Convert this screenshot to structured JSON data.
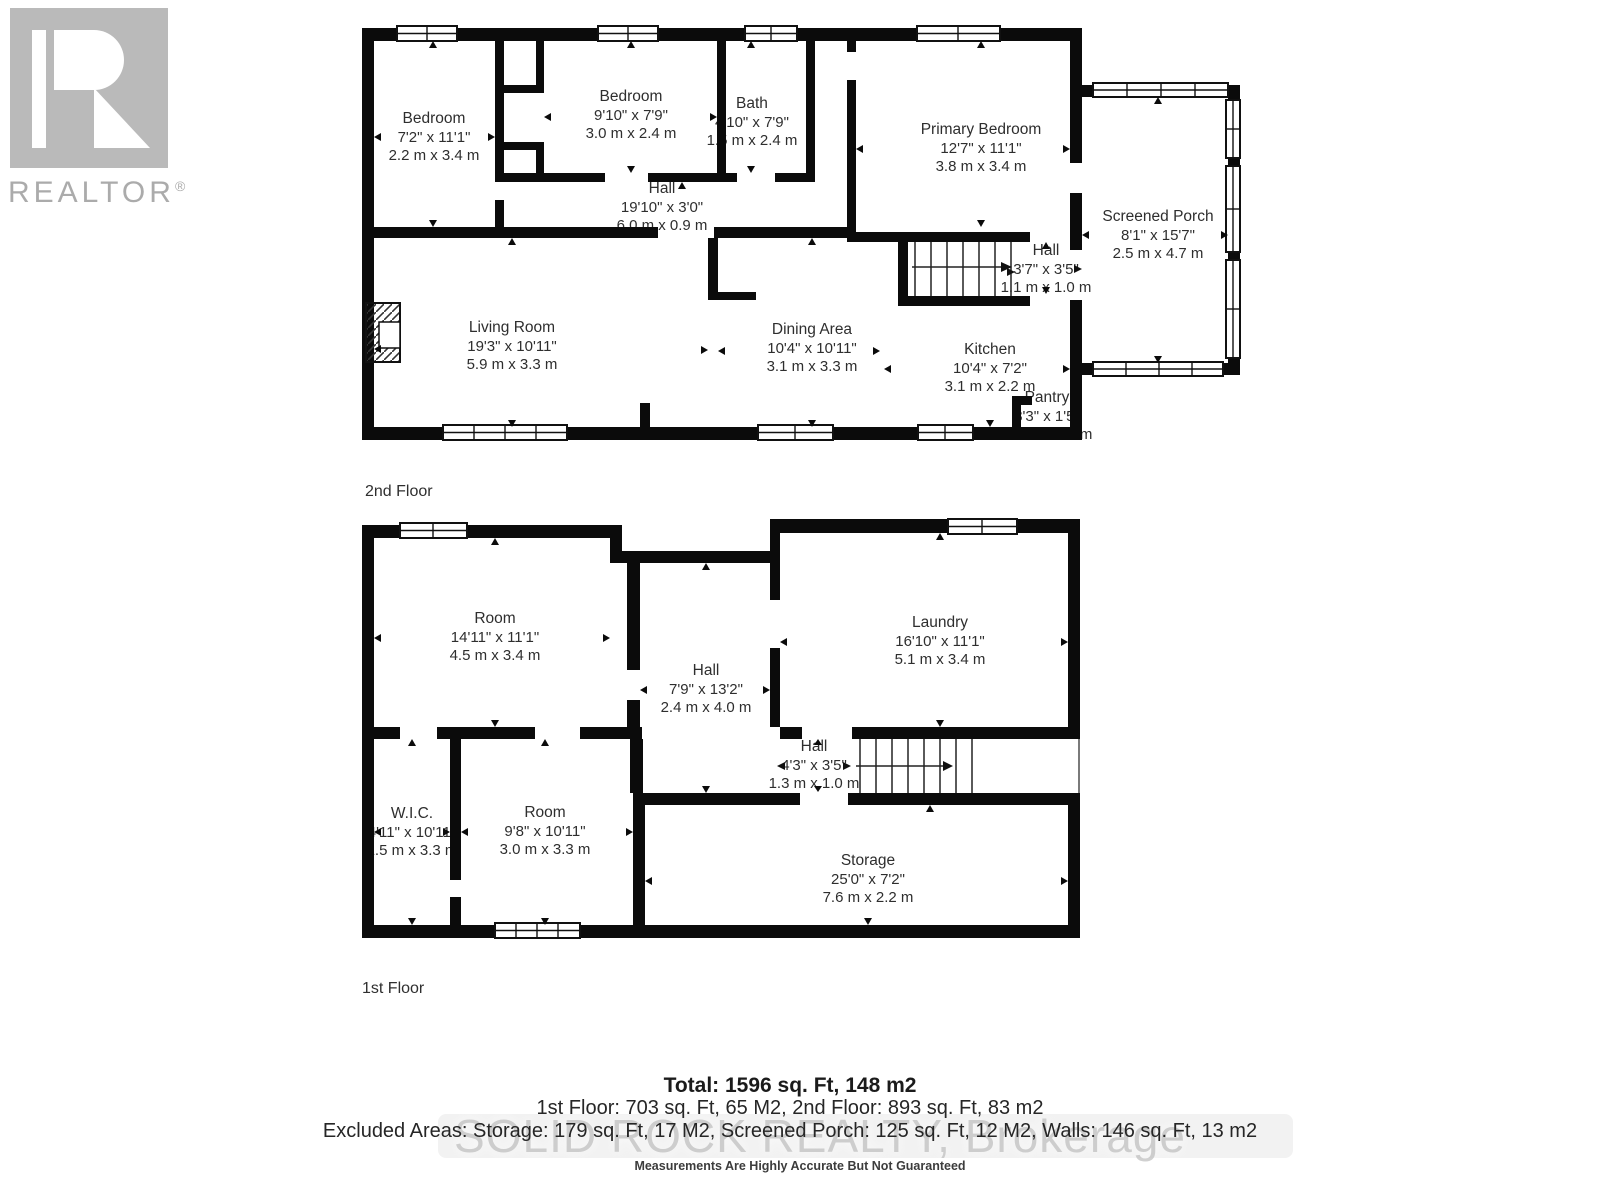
{
  "logo": {
    "brand": "REALTOR",
    "registered": "®"
  },
  "floors": [
    {
      "label": "2nd Floor",
      "rooms": [
        {
          "name": "Bedroom",
          "imperial": "7'2\" x 11'1\"",
          "metric": "2.2 m x 3.4 m"
        },
        {
          "name": "Bedroom",
          "imperial": "9'10\" x 7'9\"",
          "metric": "3.0 m x 2.4 m"
        },
        {
          "name": "Bath",
          "imperial": "4'10\" x 7'9\"",
          "metric": "1.5 m x 2.4 m"
        },
        {
          "name": "Primary Bedroom",
          "imperial": "12'7\" x 11'1\"",
          "metric": "3.8 m x 3.4 m"
        },
        {
          "name": "Screened Porch",
          "imperial": "8'1\" x 15'7\"",
          "metric": "2.5 m x 4.7 m"
        },
        {
          "name": "Hall",
          "imperial": "19'10\" x 3'0\"",
          "metric": "6.0 m x 0.9 m"
        },
        {
          "name": "Hall",
          "imperial": "3'7\" x 3'5\"",
          "metric": "1.1 m x 1.0 m"
        },
        {
          "name": "Living Room",
          "imperial": "19'3\" x 10'11\"",
          "metric": "5.9 m x 3.3 m"
        },
        {
          "name": "Dining Area",
          "imperial": "10'4\" x 10'11\"",
          "metric": "3.1 m x 3.3 m"
        },
        {
          "name": "Kitchen",
          "imperial": "10'4\" x 7'2\"",
          "metric": "3.1 m x 2.2 m"
        },
        {
          "name": "Pantry",
          "imperial": "3'3\" x 1'5\"",
          "metric": "1.0 m x 0.4 m"
        }
      ]
    },
    {
      "label": "1st Floor",
      "rooms": [
        {
          "name": "Room",
          "imperial": "14'11\" x 11'1\"",
          "metric": "4.5 m x 3.4 m"
        },
        {
          "name": "Hall",
          "imperial": "7'9\" x 13'2\"",
          "metric": "2.4 m x 4.0 m"
        },
        {
          "name": "Laundry",
          "imperial": "16'10\" x 11'1\"",
          "metric": "5.1 m x 3.4 m"
        },
        {
          "name": "Hall",
          "imperial": "4'3\" x 3'5\"",
          "metric": "1.3 m x 1.0 m"
        },
        {
          "name": "W.I.C.",
          "imperial": "4'11\" x 10'11\"",
          "metric": "1.5 m x 3.3 m"
        },
        {
          "name": "Room",
          "imperial": "9'8\" x 10'11\"",
          "metric": "3.0 m x 3.3 m"
        },
        {
          "name": "Storage",
          "imperial": "25'0\" x 7'2\"",
          "metric": "7.6 m x 2.2 m"
        }
      ]
    }
  ],
  "summary": {
    "total_line": "Total: 1596 sq. Ft, 148 m2",
    "floors_line": "1st Floor: 703 sq. Ft, 65 M2, 2nd Floor: 893 sq. Ft, 83 m2",
    "excluded_line": "Excluded Areas: Storage: 179 sq. Ft, 17 M2, Screened Porch: 125 sq. Ft, 12 M2, Walls: 146 sq. Ft, 13 m2",
    "disclaimer": "Measurements Are Highly Accurate But Not Guaranteed"
  },
  "watermark": "SOLID ROCK REALTY, Brokerage",
  "colors": {
    "wall": "#0b0b0b",
    "label": "#2e2e2e",
    "summary": "#262626",
    "logo": "#bababa",
    "logotext": "#ababab",
    "watermark": "#c5c5c5"
  }
}
